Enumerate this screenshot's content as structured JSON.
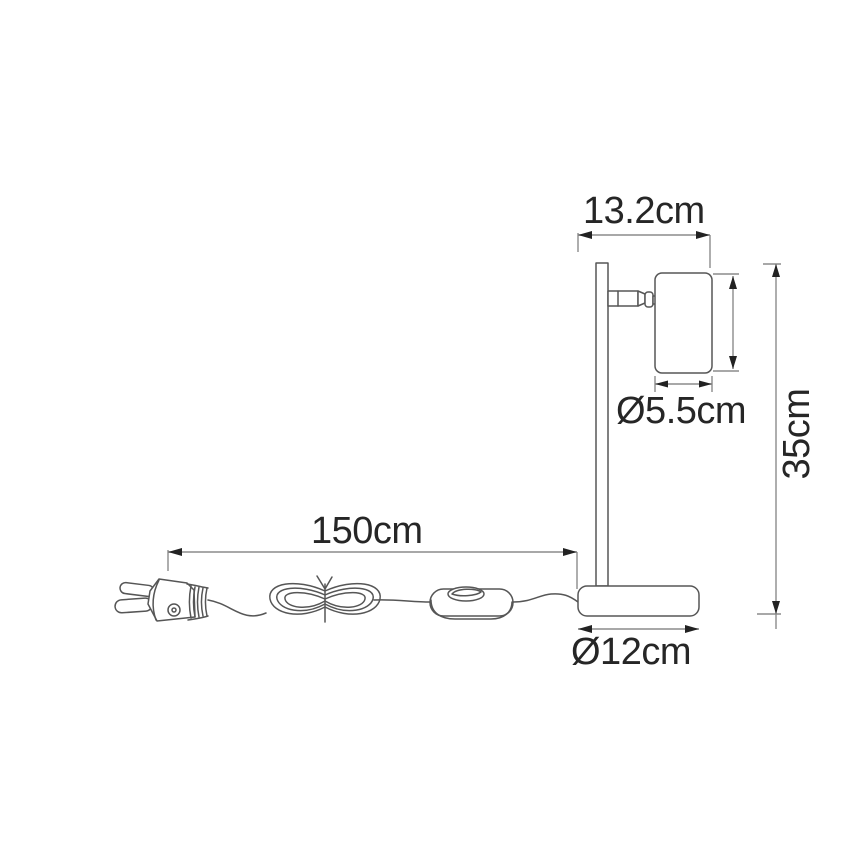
{
  "diagram": {
    "title": "Table lamp dimensional line drawing",
    "dimensions": {
      "head_width": {
        "label": "13.2cm"
      },
      "head_diameter": {
        "label": "Ø5.5cm"
      },
      "total_height": {
        "label": "35cm"
      },
      "cable_length": {
        "label": "150cm"
      },
      "base_diameter": {
        "label": "Ø12cm"
      }
    },
    "colors": {
      "background": "#ffffff",
      "outline": "#565656",
      "dimension_line": "#8c8c8c",
      "arrowhead": "#222222",
      "text": "#262626"
    }
  }
}
